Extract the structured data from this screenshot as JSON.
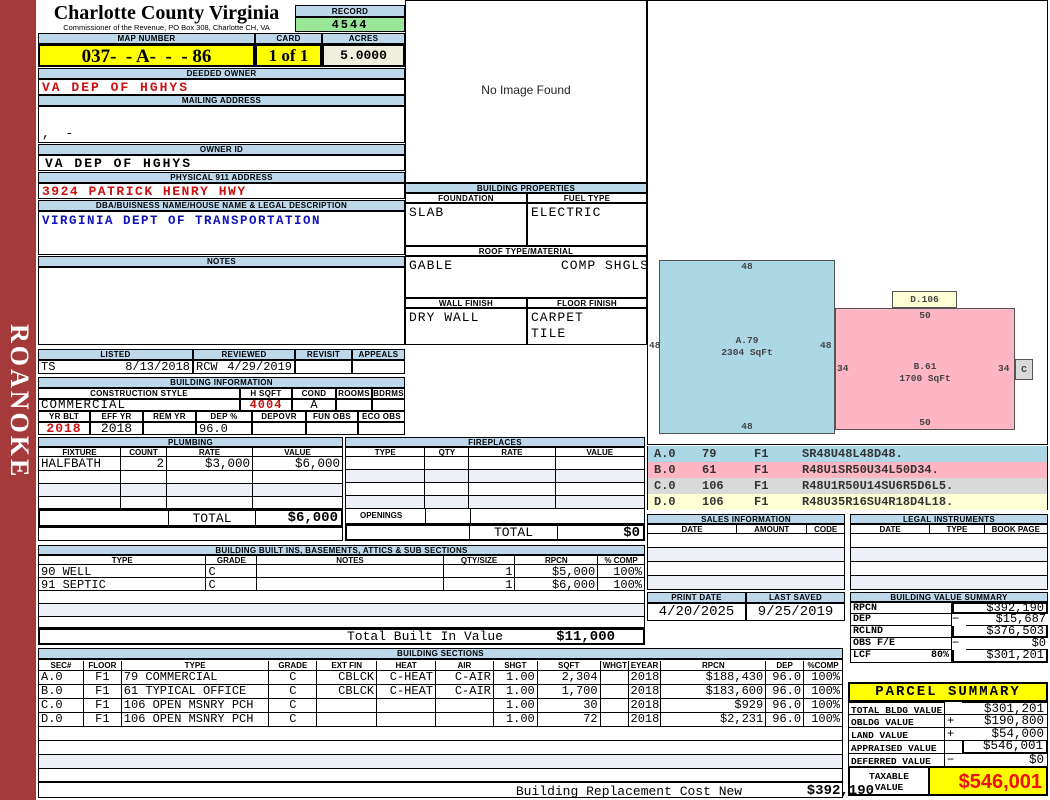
{
  "colors": {
    "sidebar_red": "#A43A3A",
    "header_bar_blue": "#BCD8EA",
    "record_green": "#99E699",
    "highlight_yellow": "#FFFF00",
    "acres_cream": "#F0EEDC",
    "value_red": "#CC1111",
    "desc_blue": "#1111BB",
    "row_stripe": "#EEF0F8",
    "sketch_blue": "#ACD8E6",
    "sketch_pink": "#FFB6C4",
    "legend_gray": "#D9D9D9",
    "legend_yellow": "#FFFFD6",
    "taxable_red": "#EE1111"
  },
  "sidebar": {
    "label": "ROANOKE"
  },
  "header": {
    "county": "Charlotte County Virginia",
    "commissioner": "Commissioner of the Revenue, PO Box 308, Charlotte CH, VA",
    "record_label": "RECORD",
    "record": "4544",
    "map_number_label": "MAP NUMBER",
    "map_number": "037-  - A-  -  - 86",
    "card_label": "CARD",
    "card": "1 of 1",
    "acres_label": "ACRES",
    "acres": "5.0000"
  },
  "owner": {
    "deeded_owner_label": "DEEDED OWNER",
    "deeded_owner": "VA DEP OF HGHYS",
    "mailing_address_label": "MAILING ADDRESS",
    "mailing_address": ",  -",
    "owner_id_label": "OWNER ID",
    "owner_id": "VA DEP OF HGHYS",
    "physical_address_label": "PHYSICAL 911 ADDRESS",
    "physical_address": "3924 PATRICK HENRY HWY",
    "dba_label": "DBA/BUISNESS NAME/HOUSE NAME & LEGAL DESCRIPTION",
    "dba": "VIRGINIA DEPT OF TRANSPORTATION",
    "notes_label": "NOTES"
  },
  "review": {
    "listed_label": "LISTED",
    "listed_by": "TS",
    "listed_date": "8/13/2018",
    "reviewed_label": "REVIEWED",
    "reviewed_by": "RCW",
    "reviewed_date": "4/29/2019",
    "revisit_label": "REVISIT",
    "appeals_label": "APPEALS"
  },
  "building_info": {
    "title": "BUILDING INFORMATION",
    "style_label": "CONSTRUCTION STYLE",
    "style": "COMMERCIAL",
    "hsqft_label": "H SQFT",
    "hsqft": "4004",
    "cond_label": "COND",
    "cond": "A",
    "rooms_label": "ROOMS",
    "bdrms_label": "BDRMS",
    "yrblt_label": "YR BLT",
    "yrblt": "2018",
    "effyr_label": "EFF YR",
    "effyr": "2018",
    "remyr_label": "REM YR",
    "dep_label": "DEP %",
    "dep": "96.0",
    "depovr_label": "DEPOVR",
    "funobs_label": "FUN OBS",
    "ecoobs_label": "ECO OBS"
  },
  "plumbing": {
    "title": "PLUMBING",
    "headers": [
      "FIXTURE",
      "COUNT",
      "RATE",
      "VALUE"
    ],
    "rows": [
      [
        "HALFBATH",
        "2",
        "$3,000",
        "$6,000"
      ]
    ],
    "total_label": "TOTAL",
    "total": "$6,000"
  },
  "fireplaces": {
    "title": "FIREPLACES",
    "headers": [
      "TYPE",
      "QTY",
      "RATE",
      "VALUE"
    ],
    "openings_label": "OPENINGS",
    "total_label": "TOTAL",
    "total": "$0"
  },
  "built_ins": {
    "title": "BUILDING BUILT INS, BASEMENTS, ATTICS & SUB SECTIONS",
    "headers": [
      "TYPE",
      "GRADE",
      "NOTES",
      "QTY/SIZE",
      "RPCN",
      "% COMP"
    ],
    "rows": [
      [
        "90 WELL",
        "C",
        "",
        "1",
        "$5,000",
        "100%"
      ],
      [
        "91 SEPTIC",
        "C",
        "",
        "1",
        "$6,000",
        "100%"
      ]
    ],
    "total_label": "Total Built In Value",
    "total": "$11,000"
  },
  "sections": {
    "title": "BUILDING SECTIONS",
    "headers": [
      "SEC#",
      "FLOOR",
      "TYPE",
      "GRADE",
      "EXT FIN",
      "HEAT",
      "AIR",
      "SHGT",
      "SQFT",
      "WHGT",
      "EYEAR",
      "RPCN",
      "DEP",
      "%COMP"
    ],
    "rows": [
      [
        "A.0",
        "F1",
        "79 COMMERCIAL",
        "C",
        "CBLCK",
        "C-HEAT",
        "C-AIR",
        "1.00",
        "2,304",
        "",
        "2018",
        "$188,430",
        "96.0",
        "100%"
      ],
      [
        "B.0",
        "F1",
        "61 TYPICAL OFFICE",
        "C",
        "CBLCK",
        "C-HEAT",
        "C-AIR",
        "1.00",
        "1,700",
        "",
        "2018",
        "$183,600",
        "96.0",
        "100%"
      ],
      [
        "C.0",
        "F1",
        "106 OPEN MSNRY PCH",
        "C",
        "",
        "",
        "",
        "1.00",
        "30",
        "",
        "2018",
        "$929",
        "96.0",
        "100%"
      ],
      [
        "D.0",
        "F1",
        "106 OPEN MSNRY PCH",
        "C",
        "",
        "",
        "",
        "1.00",
        "72",
        "",
        "2018",
        "$2,231",
        "96.0",
        "100%"
      ]
    ],
    "footer_label": "Building Replacement Cost New",
    "footer_value": "$392,190"
  },
  "photo": {
    "placeholder": "No Image Found"
  },
  "properties": {
    "title": "BUILDING PROPERTIES",
    "foundation_label": "FOUNDATION",
    "foundation": "SLAB",
    "fuel_label": "FUEL TYPE",
    "fuel": "ELECTRIC",
    "roof_label": "ROOF TYPE/MATERIAL",
    "roof_type": "GABLE",
    "roof_material": "COMP SHGLS",
    "wall_label": "WALL FINISH",
    "wall": "DRY WALL",
    "floor_label": "FLOOR FINISH",
    "floor_line1": "CARPET",
    "floor_line2": "TILE"
  },
  "sketch": {
    "a": {
      "name": "A.79",
      "sqft": "2304 SqFt",
      "top": "48",
      "left": "48",
      "right": "48",
      "bottom": "48"
    },
    "b": {
      "name": "B.61",
      "sqft": "1700 SqFt",
      "top": "50",
      "left": "34",
      "right": "34",
      "bottom": "50"
    },
    "d_label": "D.106",
    "c_label": "C"
  },
  "legend": {
    "rows": [
      [
        "A.0",
        "79",
        "F1",
        "SR48U48L48D48."
      ],
      [
        "B.0",
        "61",
        "F1",
        "R48U1SR50U34L50D34."
      ],
      [
        "C.0",
        "106",
        "F1",
        "R48U1R50U14SU6R5D6L5."
      ],
      [
        "D.0",
        "106",
        "F1",
        "R48U35R16SU4R18D4L18."
      ]
    ]
  },
  "sales": {
    "title": "SALES INFORMATION",
    "headers": [
      "DATE",
      "AMOUNT",
      "CODE"
    ]
  },
  "legal": {
    "title": "LEGAL INSTRUMENTS",
    "headers": [
      "DATE",
      "TYPE",
      "BOOK PAGE"
    ]
  },
  "dates": {
    "print_label": "PRINT DATE",
    "print": "4/20/2025",
    "saved_label": "LAST SAVED",
    "saved": "9/25/2019"
  },
  "value_summary": {
    "title": "BUILDING VALUE SUMMARY",
    "rows": [
      {
        "label": "RPCN",
        "op": "",
        "value": "$392,190"
      },
      {
        "label": "DEP",
        "op": "−",
        "value": "$15,687"
      },
      {
        "label": "RCLND",
        "op": "",
        "value": "$376,503"
      },
      {
        "label": "OBS F/E",
        "op": "−",
        "value": "$0"
      },
      {
        "label": "LCF",
        "pct": "80%",
        "op": "",
        "value": "$301,201"
      }
    ]
  },
  "parcel": {
    "title": "PARCEL SUMMARY",
    "rows": [
      {
        "label": "TOTAL BLDG VALUE",
        "op": "",
        "value": "$301,201"
      },
      {
        "label": "OBLDG VALUE",
        "op": "+",
        "value": "$190,800"
      },
      {
        "label": "LAND VALUE",
        "op": "+",
        "value": "$54,000"
      },
      {
        "label": "APPRAISED VALUE",
        "op": "",
        "value": "$546,001"
      },
      {
        "label": "DEFERRED VALUE",
        "op": "−",
        "value": "$0"
      }
    ],
    "taxable_label1": "TAXABLE",
    "taxable_label2": "VALUE",
    "taxable": "$546,001"
  }
}
